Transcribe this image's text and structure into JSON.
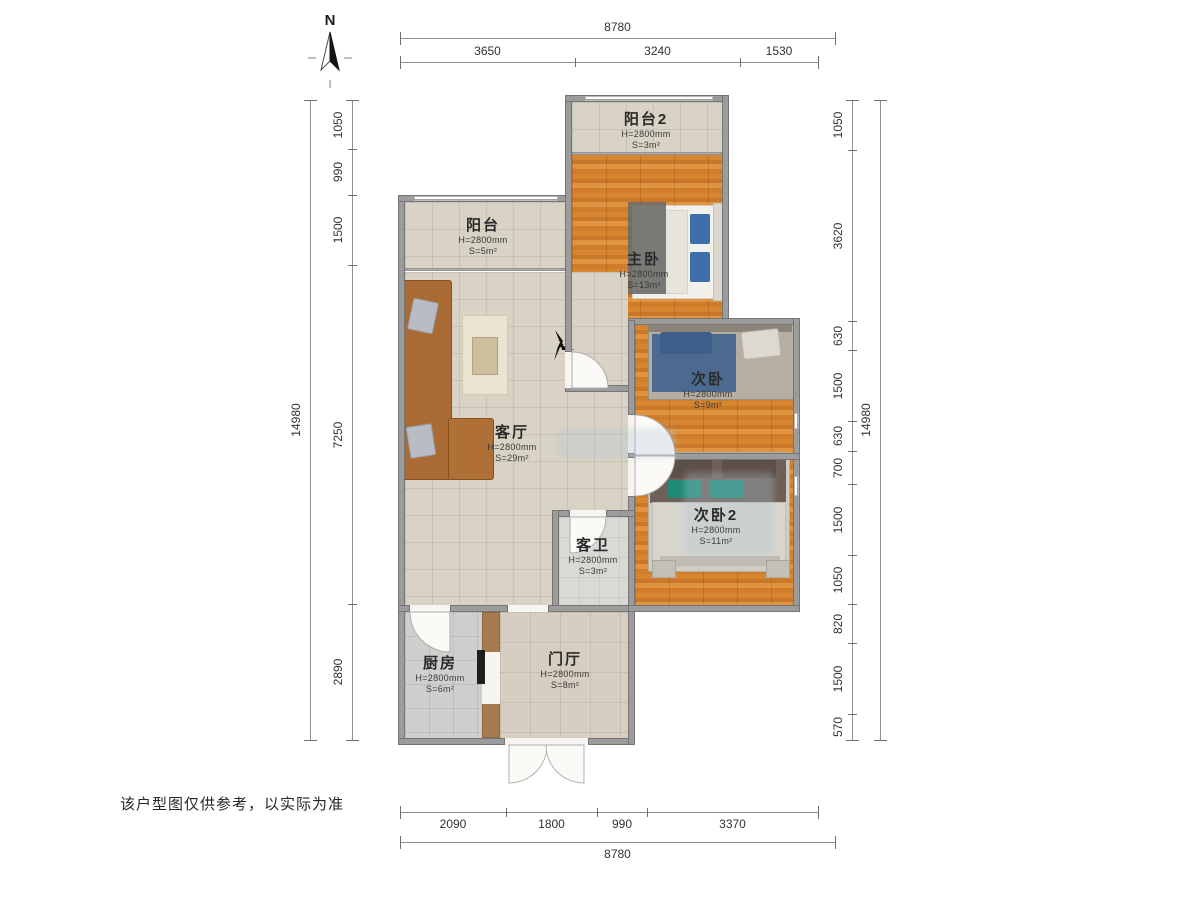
{
  "meta": {
    "north_label": "N",
    "disclaimer": "该户型图仅供参考，以实际为准",
    "icons": [
      "compass-north-icon",
      "ceiling-fan-icon"
    ]
  },
  "rooms": [
    {
      "name": "阳台2",
      "height": "H=2800mm",
      "area": "S=3m²"
    },
    {
      "name": "阳台",
      "height": "H=2800mm",
      "area": "S=5m²"
    },
    {
      "name": "主卧",
      "height": "H=2800mm",
      "area": "S=13m²"
    },
    {
      "name": "次卧",
      "height": "H=2800mm",
      "area": "S=9m²"
    },
    {
      "name": "客厅",
      "height": "H=2800mm",
      "area": "S=29m²"
    },
    {
      "name": "次卧2",
      "height": "H=2800mm",
      "area": "S=11m²"
    },
    {
      "name": "客卫",
      "height": "H=2800mm",
      "area": "S=3m²"
    },
    {
      "name": "厨房",
      "height": "H=2800mm",
      "area": "S=6m²"
    },
    {
      "name": "门厅",
      "height": "H=2800mm",
      "area": "S=8m²"
    }
  ],
  "dimensions": {
    "top": {
      "total": "8780",
      "segments": [
        "3650",
        "3240",
        "1530"
      ]
    },
    "bottom": {
      "total": "8780",
      "segments": [
        "2090",
        "1800",
        "990",
        "3370"
      ]
    },
    "left": {
      "total": "14980",
      "segments": [
        "1050",
        "990",
        "1500",
        "7250",
        "2890"
      ]
    },
    "right": {
      "total": "14980",
      "segments": [
        "1050",
        "3620",
        "630",
        "1500",
        "630",
        "700",
        "1500",
        "1050",
        "820",
        "1500",
        "570"
      ]
    }
  },
  "colors": {
    "wood_floor": "#d6862f",
    "tile": "#d9d3c5",
    "wall": "#9c9c9c",
    "sofa": "#a96a33",
    "pillow_blue": "#3f6fa8",
    "cushion_teal": "#1f8a76"
  }
}
